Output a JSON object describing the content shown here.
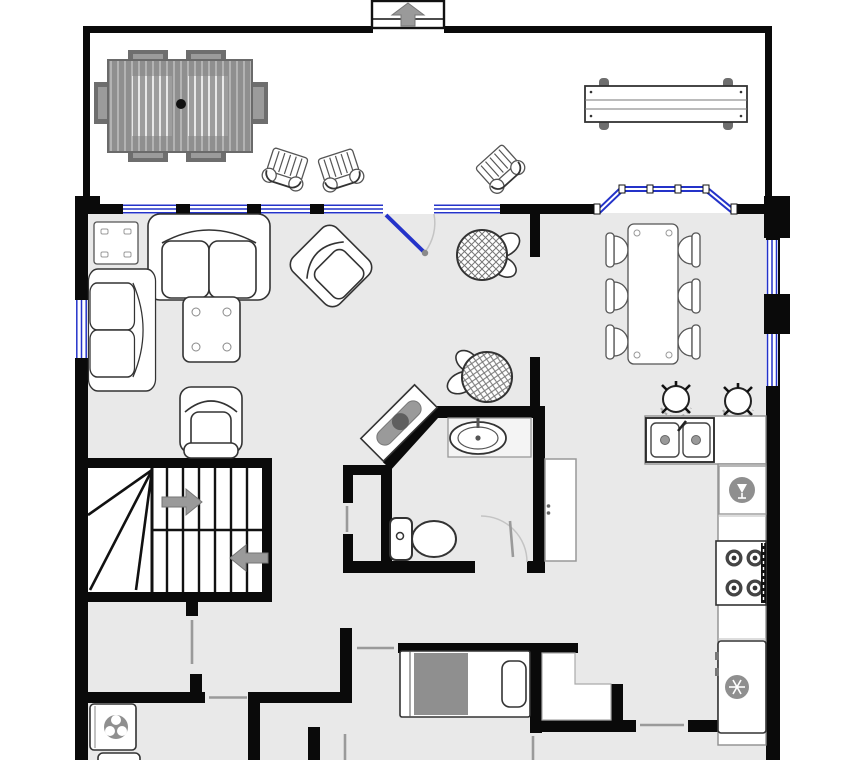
{
  "title": "floor-plan",
  "colors": {
    "background": "#ffffff",
    "wall": "#0a0a0a",
    "floor": "#e9e9e9",
    "window_blue": "#2433c9",
    "furniture_fill": "#ffffff",
    "furniture_outline": "#333333",
    "deck_wood": "#8f8f8f",
    "deck_wood_dark": "#6e6e6e",
    "appliance_icon": "#8f8f8f",
    "arrow": "#9a9a9a",
    "door_swing": "#9a9a9a",
    "counter_edge": "#8f8f8f"
  },
  "rooms": [
    {
      "name": "deck",
      "items": [
        {
          "item": "picnic-table",
          "count": 1
        },
        {
          "item": "deck-chair",
          "count": 3
        },
        {
          "item": "bench",
          "count": 1
        },
        {
          "item": "entry-steps",
          "count": 1
        }
      ]
    },
    {
      "name": "living-room",
      "items": [
        {
          "item": "loveseat",
          "count": 1
        },
        {
          "item": "sofa",
          "count": 1
        },
        {
          "item": "armchair",
          "count": 1
        },
        {
          "item": "recliner",
          "count": 1
        },
        {
          "item": "coffee-table",
          "count": 1
        },
        {
          "item": "end-table",
          "count": 1
        },
        {
          "item": "console-table",
          "count": 1
        },
        {
          "item": "potted-plant",
          "count": 2
        },
        {
          "item": "entry-door",
          "count": 1
        }
      ]
    },
    {
      "name": "dining-area",
      "items": [
        {
          "item": "dining-table",
          "count": 1
        },
        {
          "item": "dining-chair",
          "count": 6
        },
        {
          "item": "bar-stool",
          "count": 2
        },
        {
          "item": "bay-window",
          "count": 1
        }
      ]
    },
    {
      "name": "kitchen",
      "items": [
        {
          "item": "double-sink",
          "count": 1
        },
        {
          "item": "dishwasher",
          "count": 1
        },
        {
          "item": "stove",
          "count": 1
        },
        {
          "item": "refrigerator",
          "count": 1
        },
        {
          "item": "pantry-cabinet",
          "count": 1
        }
      ]
    },
    {
      "name": "bathroom",
      "items": [
        {
          "item": "vanity-sink",
          "count": 1
        },
        {
          "item": "toilet",
          "count": 1
        },
        {
          "item": "door",
          "count": 1
        },
        {
          "item": "closet",
          "count": 1
        }
      ]
    },
    {
      "name": "stairs",
      "items": [
        {
          "item": "up-arrow",
          "count": 1
        },
        {
          "item": "down-arrow",
          "count": 1
        }
      ]
    },
    {
      "name": "laundry-room",
      "items": [
        {
          "item": "washer",
          "count": 1
        },
        {
          "item": "dryer",
          "count": 1
        }
      ]
    },
    {
      "name": "bedroom",
      "items": [
        {
          "item": "bed",
          "count": 1
        },
        {
          "item": "closet",
          "count": 1
        }
      ]
    }
  ]
}
